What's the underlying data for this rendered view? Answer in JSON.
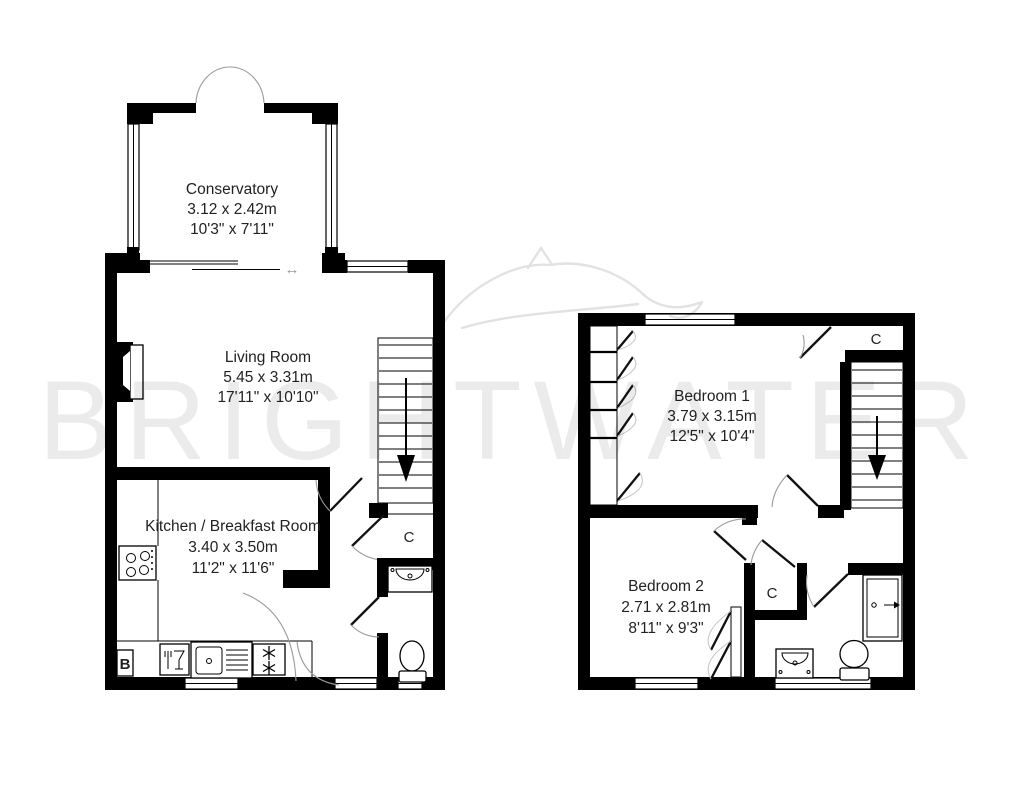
{
  "watermark": {
    "text": "BRIGHTWATER"
  },
  "icons": {
    "sliding_door_arrow": "↔"
  },
  "ground_floor": {
    "conservatory": {
      "name": "Conservatory",
      "metric": "3.12 x 2.42m",
      "imperial": "10'3\" x 7'11\""
    },
    "living_room": {
      "name": "Living Room",
      "metric": "5.45 x 3.31m",
      "imperial": "17'11\" x 10'10\""
    },
    "kitchen": {
      "name": "Kitchen / Breakfast Room",
      "metric": "3.40 x 3.50m",
      "imperial": "11'2\" x 11'6\""
    },
    "cupboard_label": "C",
    "boiler_label": "B"
  },
  "first_floor": {
    "bedroom1": {
      "name": "Bedroom 1",
      "metric": "3.79 x 3.15m",
      "imperial": "12'5\" x 10'4\""
    },
    "bedroom2": {
      "name": "Bedroom 2",
      "metric": "2.71 x 2.81m",
      "imperial": "8'11\" x 9'3\""
    },
    "cupboard_top_label": "C",
    "cupboard_landing_label": "C"
  }
}
